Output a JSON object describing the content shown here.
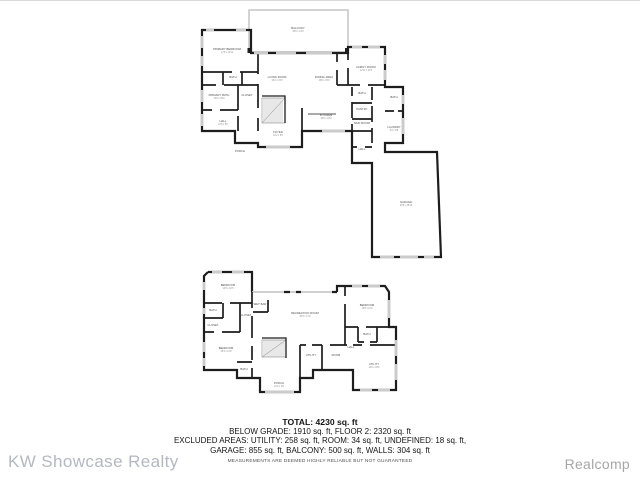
{
  "summary": {
    "total": "TOTAL: 4230 sq. ft",
    "line2": "BELOW GRADE: 1910 sq. ft, FLOOR 2: 2320 sq. ft",
    "line3": "EXCLUDED AREAS: UTILITY: 258 sq. ft, ROOM: 34 sq. ft, UNDEFINED: 18 sq. ft,",
    "line4": "GARAGE: 855 sq. ft, BALCONY: 500 sq. ft, WALLS: 304 sq. ft",
    "disclaimer": "MEASUREMENTS ARE DEEMED HIGHLY RELIABLE BUT NOT GUARANTEED"
  },
  "watermarks": {
    "left": "KW Showcase Realty",
    "right": "Realcomp"
  },
  "colors": {
    "wall": "#1d1d1d",
    "opening": "#cbcbcb",
    "balcony_outline": "#c8c8c8",
    "room_label": "#4a4a4a",
    "room_dims": "#8c8c8c",
    "watermark_left": "#b4b8c0",
    "watermark_right": "#a7a7a7"
  },
  "floors": [
    {
      "name": "floor-2",
      "rooms": [
        {
          "name": "BALCONY",
          "dims": "35'0 x 14'3",
          "x": 298,
          "y": 29
        },
        {
          "name": "PRIMARY BEDROOM",
          "dims": "17'8 x 14'11",
          "x": 227,
          "y": 50
        },
        {
          "name": "BATH",
          "dims": "",
          "x": 233,
          "y": 78
        },
        {
          "name": "PRIMARY BATH",
          "dims": "12'9 x 8'10",
          "x": 219,
          "y": 96
        },
        {
          "name": "CLOSET",
          "dims": "",
          "x": 247,
          "y": 96
        },
        {
          "name": "HALL",
          "dims": "14'6 x 5'8",
          "x": 223,
          "y": 122
        },
        {
          "name": "PORCH",
          "dims": "",
          "x": 240,
          "y": 152
        },
        {
          "name": "FOYER",
          "dims": "10'2 x 6'5",
          "x": 278,
          "y": 133
        },
        {
          "name": "LIVING ROOM",
          "dims": "16'4 x 15'0",
          "x": 277,
          "y": 78
        },
        {
          "name": "DINING AREA",
          "dims": "15'8 x 15'0",
          "x": 324,
          "y": 78
        },
        {
          "name": "KITCHEN",
          "dims": "16'0 x 10'9",
          "x": 326,
          "y": 116
        },
        {
          "name": "FAMILY ROOM",
          "dims": "12'11 x 13'5",
          "x": 366,
          "y": 68
        },
        {
          "name": "BATH",
          "dims": "",
          "x": 362,
          "y": 94
        },
        {
          "name": "PANTRY",
          "dims": "",
          "x": 362,
          "y": 110
        },
        {
          "name": "MUD ROOM",
          "dims": "",
          "x": 362,
          "y": 124
        },
        {
          "name": "BATH",
          "dims": "",
          "x": 394,
          "y": 98
        },
        {
          "name": "LAUNDRY",
          "dims": "6'2 x 9'8",
          "x": 394,
          "y": 128
        },
        {
          "name": "HALL",
          "dims": "",
          "x": 362,
          "y": 150
        },
        {
          "name": "GARAGE",
          "dims": "29'6 x 28'10",
          "x": 406,
          "y": 203
        }
      ]
    },
    {
      "name": "below-grade",
      "rooms": [
        {
          "name": "BEDROOM",
          "dims": "14'5 x 10'5",
          "x": 228,
          "y": 286
        },
        {
          "name": "BATH",
          "dims": "",
          "x": 213,
          "y": 311
        },
        {
          "name": "CLOSET",
          "dims": "",
          "x": 213,
          "y": 326
        },
        {
          "name": "CLOSET",
          "dims": "",
          "x": 246,
          "y": 316
        },
        {
          "name": "BEDROOM",
          "dims": "15'2 x 11'8",
          "x": 226,
          "y": 349
        },
        {
          "name": "BATH",
          "dims": "",
          "x": 244,
          "y": 370
        },
        {
          "name": "WET BAR",
          "dims": "",
          "x": 260,
          "y": 305
        },
        {
          "name": "RECREATION ROOM",
          "dims": "30'2 x 17'9",
          "x": 305,
          "y": 314
        },
        {
          "name": "BEDROOM",
          "dims": "12'8 x 11'6",
          "x": 367,
          "y": 306
        },
        {
          "name": "BATH",
          "dims": "",
          "x": 367,
          "y": 335
        },
        {
          "name": "HALL",
          "dims": "",
          "x": 351,
          "y": 348
        },
        {
          "name": "UTILITY",
          "dims": "",
          "x": 311,
          "y": 356
        },
        {
          "name": "ROOM",
          "dims": "",
          "x": 336,
          "y": 356
        },
        {
          "name": "UTILITY",
          "dims": "14'0 x 18'5",
          "x": 374,
          "y": 365
        },
        {
          "name": "PORCH",
          "dims": "13'4 x 4'6",
          "x": 279,
          "y": 384
        }
      ]
    }
  ]
}
